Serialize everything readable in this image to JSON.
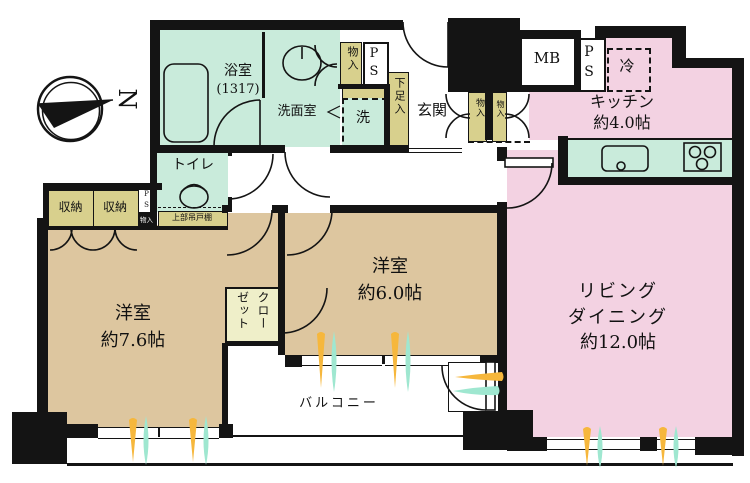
{
  "title": "マンション間取り図",
  "compass": {
    "north_label": "N"
  },
  "colors": {
    "wall": "#141414",
    "mint": "#c9ebdb",
    "pink": "#f3d2e2",
    "tan": "#ddc69f",
    "khaki": "#d8d08d",
    "cream": "#efefc9",
    "flame_orange": "#f6b73c",
    "flame_teal": "#9fe7d0"
  },
  "rooms": {
    "bath": {
      "name": "浴室",
      "size": "(1317)"
    },
    "washroom": {
      "name": "洗面室"
    },
    "laundry": {
      "name": "洗"
    },
    "toilet": {
      "name": "トイレ"
    },
    "entrance": {
      "name": "玄関"
    },
    "kitchen": {
      "name": "キッチン",
      "size": "約4.0帖"
    },
    "living": {
      "name_line1": "リビング",
      "name_line2": "ダイニング",
      "size": "約12.0帖"
    },
    "bedroom1": {
      "name": "洋室",
      "size": "約7.6帖"
    },
    "bedroom2": {
      "name": "洋室",
      "size": "約6.0帖"
    },
    "balcony": {
      "name": "バルコニー"
    }
  },
  "storage": {
    "storage_top": "物入",
    "hall_storage_1": "物入",
    "hall_storage_2": "物入",
    "storage_small": "物入",
    "closet_1": "収納",
    "closet_2": "収納",
    "wardrobe": "クローゼット",
    "shoe_box": "下足入",
    "overhead_shelf": "上部吊戸棚"
  },
  "equipment": {
    "meter_box": "MB",
    "pipe_space_top": "P\nS",
    "pipe_space_right": "P\nS",
    "pipe_space_small": "P\nS",
    "fridge": "冷"
  }
}
